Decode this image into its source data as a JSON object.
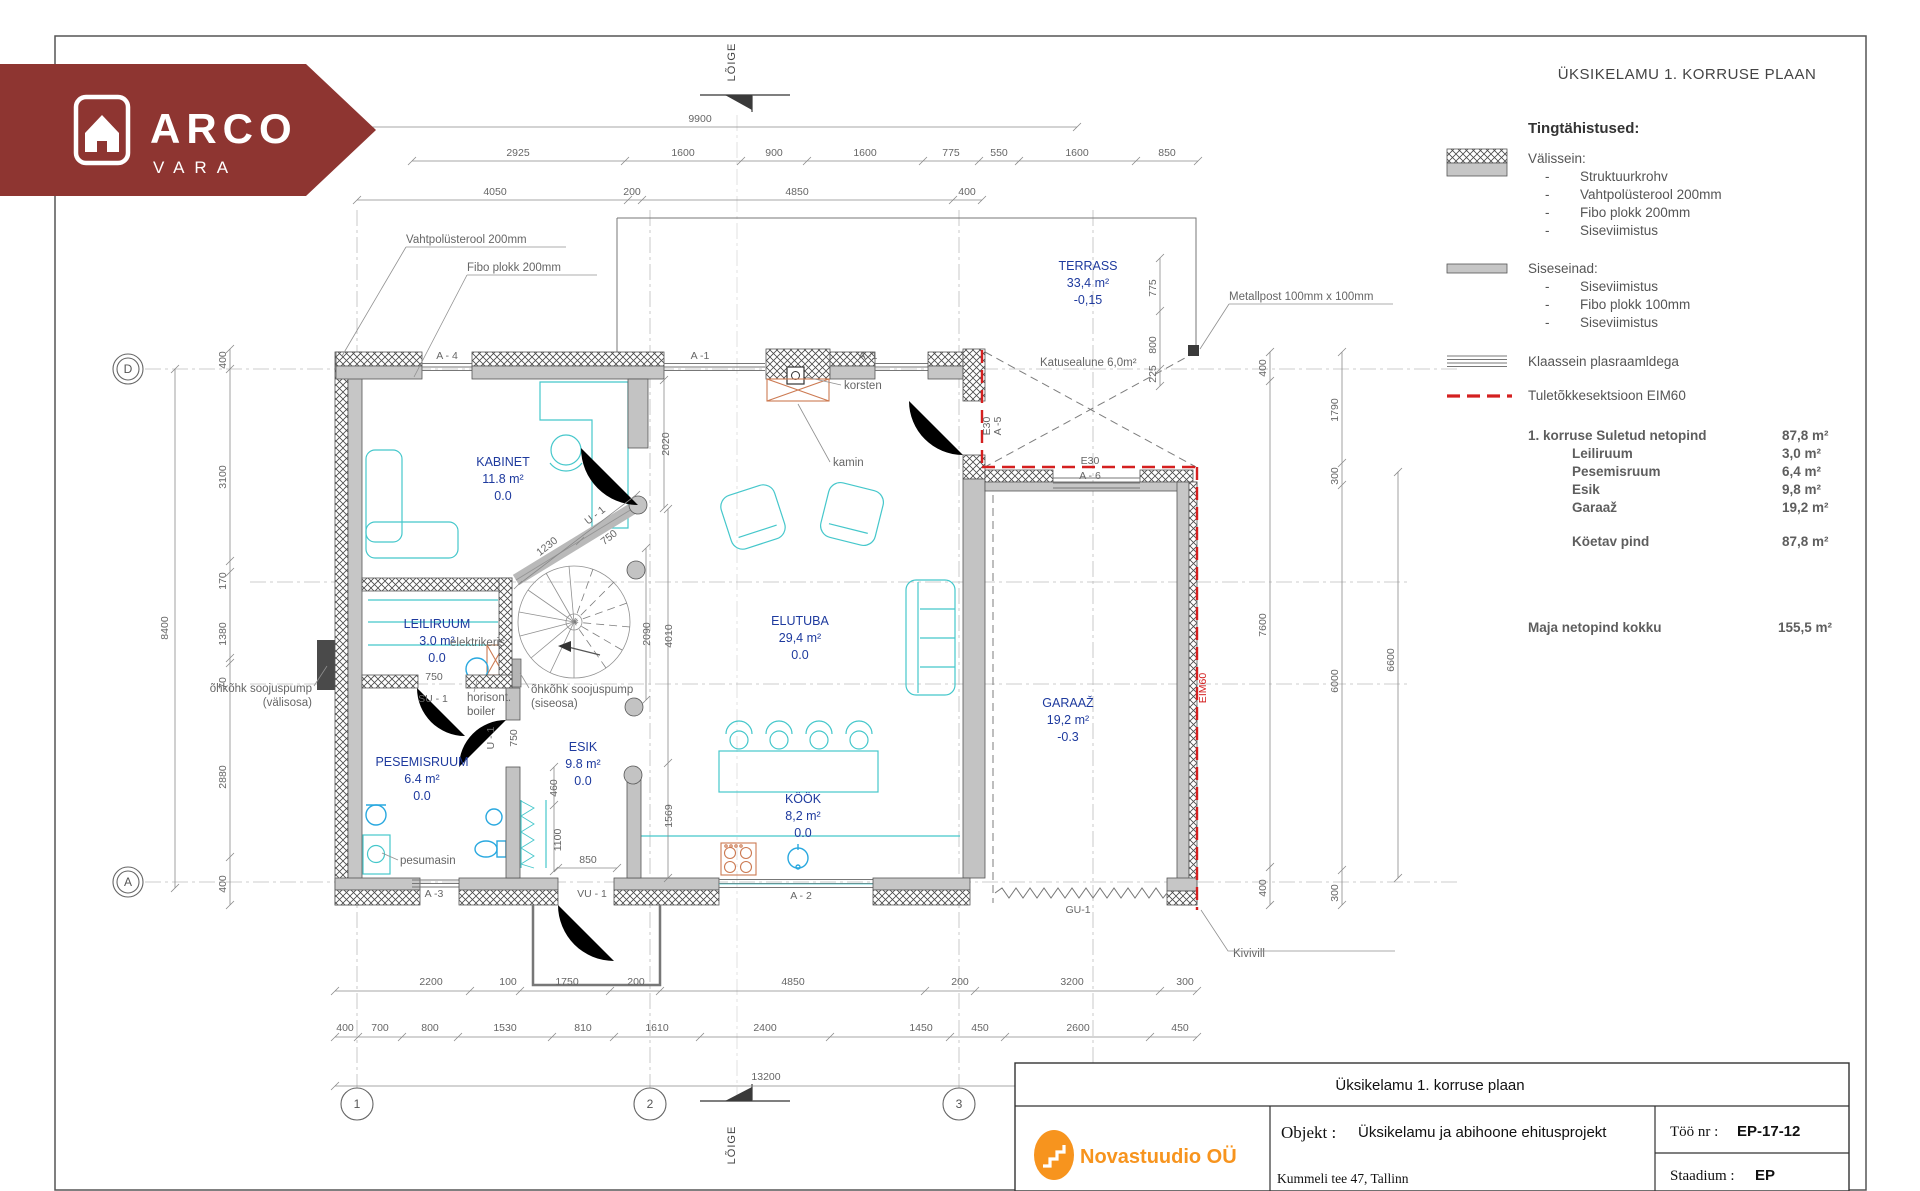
{
  "colors": {
    "banner": "#8e3531",
    "logo_orange": "#f7941e",
    "room_label": "#1e3a9e",
    "furniture_cyan": "#45c7cb",
    "fire_red": "#d42020"
  },
  "brand": {
    "line1": "ARCO",
    "line2": "VARA"
  },
  "drawing_header": {
    "title": "ÜKSIKELAMU 1. KORRUSE PLAAN"
  },
  "legend": {
    "heading": "Tingtähistused:",
    "bullet": "-",
    "exterior": {
      "label": "Välissein:",
      "items": [
        "Struktuurkrohv",
        "Vahtpolüsterool 200mm",
        "Fibo plokk 200mm",
        "Siseviimistus"
      ]
    },
    "interior": {
      "label": "Siseseinad:",
      "items": [
        "Siseviimistus",
        "Fibo plokk 100mm",
        "Siseviimistus"
      ]
    },
    "glass": "Klaassein plasraamldega",
    "fire": "Tuletõkkesektsioon EIM60"
  },
  "areas": {
    "header": {
      "label": "1. korruse Suletud netopind",
      "value": "87,8  m²"
    },
    "rows": [
      {
        "label": "Leiliruum",
        "value": "3,0 m²"
      },
      {
        "label": "Pesemisruum",
        "value": "6,4 m²"
      },
      {
        "label": "Esik",
        "value": "9,8 m²"
      },
      {
        "label": "Garaaž",
        "value": "19,2 m²"
      }
    ],
    "heated": {
      "label": "Köetav pind",
      "value": "87,8 m²"
    },
    "total": {
      "label": "Maja netopind kokku",
      "value": "155,5 m²"
    }
  },
  "title_block": {
    "drawing_name": "Üksikelamu 1. korruse plaan",
    "company": "Novastuudio OÜ",
    "object_label": "Objekt :",
    "object_value": "Üksikelamu ja abihoone ehitusprojekt",
    "address": "Kummeli tee 47, Tallinn",
    "work_no_label": "Töö nr :",
    "work_no_value": "EP-17-12",
    "stage_label": "Staadium :",
    "stage_value": "EP"
  },
  "plan": {
    "grid_cols": [
      "1",
      "2",
      "3"
    ],
    "grid_rows": [
      "D",
      "A"
    ],
    "section_label": "LÕIGE",
    "rooms": [
      {
        "name": "KABINET",
        "area": "11.8 m²",
        "level": "0.0",
        "x": 503,
        "y": 466
      },
      {
        "name": "LEILIRUUM",
        "area": "3.0 m²",
        "level": "0.0",
        "x": 437,
        "y": 628
      },
      {
        "name": "PESEMISRUUM",
        "area": "6.4 m²",
        "level": "0.0",
        "x": 422,
        "y": 766
      },
      {
        "name": "ESIK",
        "area": "9.8 m²",
        "level": "0.0",
        "x": 583,
        "y": 751
      },
      {
        "name": "ELUTUBA",
        "area": "29,4 m²",
        "level": "0.0",
        "x": 800,
        "y": 625
      },
      {
        "name": "KÖÖK",
        "area": "8,2 m²",
        "level": "0.0",
        "x": 803,
        "y": 803
      },
      {
        "name": "GARAAŽ",
        "area": "19,2 m²",
        "level": "-0.3",
        "x": 1068,
        "y": 707
      },
      {
        "name": "TERRASS",
        "area": "33,4 m²",
        "level": "-0,15",
        "x": 1088,
        "y": 270
      }
    ],
    "callouts": [
      {
        "t": "Vahtpolüsterool 200mm",
        "x": 406,
        "y": 243,
        "ul": 566,
        "lead": "406,247 342,356"
      },
      {
        "t": "Fibo plokk 200mm",
        "x": 467,
        "y": 271,
        "ul": 597,
        "lead": "467,275 414,377"
      },
      {
        "t": "Metallpost 100mm x 100mm",
        "x": 1229,
        "y": 300,
        "ul": 1393,
        "lead": "1229,304 1200,349"
      },
      {
        "t": "korsten",
        "x": 844,
        "y": 389,
        "lead": "841,385 806,377"
      },
      {
        "t": "kamin",
        "x": 833,
        "y": 466,
        "lead": "830,462 798,404"
      },
      {
        "t": "õhkõhk soojuspump",
        "t2": "(välisosa)",
        "x": 312,
        "y": 692,
        "end": true,
        "lead": "314,686 327,666"
      },
      {
        "t": "õhkõhk soojuspump",
        "t2": "(siseosa)",
        "x": 531,
        "y": 693,
        "lead": "529,688 520,673"
      },
      {
        "t": "horisont.",
        "t2": "boiler",
        "x": 467,
        "y": 701,
        "lead": "474,692 477,681"
      },
      {
        "t": "elektrikeris",
        "x": 450,
        "y": 646
      },
      {
        "t": "pesumasin",
        "x": 400,
        "y": 864,
        "lead": "398,860 382,853"
      },
      {
        "t": "Kivivill",
        "x": 1233,
        "y": 957,
        "lead": "1201,910 1228,951 1395,951"
      },
      {
        "t": "Katusealune 6,0m²",
        "x": 1040,
        "y": 366
      }
    ],
    "wall_tags": [
      {
        "t": "A - 4",
        "x": 447,
        "y": 359
      },
      {
        "t": "A -1",
        "x": 700,
        "y": 359
      },
      {
        "t": "A -1",
        "x": 868,
        "y": 359
      },
      {
        "t": "A -3",
        "x": 434,
        "y": 897
      },
      {
        "t": "A - 2",
        "x": 801,
        "y": 899
      },
      {
        "t": "SU - 1",
        "x": 433,
        "y": 702
      },
      {
        "t": "VU - 1",
        "x": 592,
        "y": 897
      },
      {
        "t": "GU-1",
        "x": 1078,
        "y": 913
      },
      {
        "t": "U - 1",
        "x": 597,
        "y": 518,
        "r": -38
      },
      {
        "t": "U - 1",
        "x": 494,
        "y": 738,
        "r": -90
      },
      {
        "t": "E30",
        "x": 1090,
        "y": 464
      },
      {
        "t": "A - 6",
        "x": 1090,
        "y": 479
      },
      {
        "t": "E30",
        "x": 990,
        "y": 426,
        "r": -90
      },
      {
        "t": "A -5",
        "x": 1001,
        "y": 426,
        "r": -90
      },
      {
        "t": "EIM60",
        "x": 1206,
        "y": 688,
        "r": -90,
        "red": true
      }
    ],
    "dims": [
      {
        "v": "9900",
        "x": 700,
        "y": 122
      },
      {
        "v": "2925",
        "x": 518,
        "y": 156
      },
      {
        "v": "1600",
        "x": 683,
        "y": 156
      },
      {
        "v": "900",
        "x": 774,
        "y": 156
      },
      {
        "v": "1600",
        "x": 865,
        "y": 156
      },
      {
        "v": "775",
        "x": 951,
        "y": 156
      },
      {
        "v": "550",
        "x": 999,
        "y": 156
      },
      {
        "v": "1600",
        "x": 1077,
        "y": 156
      },
      {
        "v": "850",
        "x": 1167,
        "y": 156
      },
      {
        "v": "4050",
        "x": 495,
        "y": 195
      },
      {
        "v": "200",
        "x": 632,
        "y": 195
      },
      {
        "v": "4850",
        "x": 797,
        "y": 195
      },
      {
        "v": "400",
        "x": 967,
        "y": 195
      },
      {
        "v": "8400",
        "x": 168,
        "y": 628,
        "r": -90
      },
      {
        "v": "400",
        "x": 226,
        "y": 360,
        "r": -90
      },
      {
        "v": "3100",
        "x": 226,
        "y": 477,
        "r": -90
      },
      {
        "v": "170",
        "x": 226,
        "y": 581,
        "r": -90
      },
      {
        "v": "1380",
        "x": 226,
        "y": 634,
        "r": -90
      },
      {
        "v": "70",
        "x": 226,
        "y": 683,
        "r": -90
      },
      {
        "v": "2880",
        "x": 226,
        "y": 777,
        "r": -90
      },
      {
        "v": "400",
        "x": 226,
        "y": 884,
        "r": -90
      },
      {
        "v": "775",
        "x": 1156,
        "y": 288,
        "r": -90
      },
      {
        "v": "800",
        "x": 1156,
        "y": 345,
        "r": -90
      },
      {
        "v": "225",
        "x": 1156,
        "y": 374,
        "r": -90
      },
      {
        "v": "400",
        "x": 1266,
        "y": 368,
        "r": -90
      },
      {
        "v": "7600",
        "x": 1266,
        "y": 625,
        "r": -90
      },
      {
        "v": "400",
        "x": 1266,
        "y": 888,
        "r": -90
      },
      {
        "v": "1790",
        "x": 1338,
        "y": 410,
        "r": -90
      },
      {
        "v": "300",
        "x": 1338,
        "y": 476,
        "r": -90
      },
      {
        "v": "6000",
        "x": 1338,
        "y": 681,
        "r": -90
      },
      {
        "v": "300",
        "x": 1338,
        "y": 893,
        "r": -90
      },
      {
        "v": "6600",
        "x": 1394,
        "y": 660,
        "r": -90
      },
      {
        "v": "2200",
        "x": 431,
        "y": 985
      },
      {
        "v": "100",
        "x": 508,
        "y": 985
      },
      {
        "v": "1750",
        "x": 567,
        "y": 985
      },
      {
        "v": "200",
        "x": 636,
        "y": 985
      },
      {
        "v": "4850",
        "x": 793,
        "y": 985
      },
      {
        "v": "200",
        "x": 960,
        "y": 985
      },
      {
        "v": "3200",
        "x": 1072,
        "y": 985
      },
      {
        "v": "300",
        "x": 1185,
        "y": 985
      },
      {
        "v": "400",
        "x": 345,
        "y": 1031
      },
      {
        "v": "700",
        "x": 380,
        "y": 1031
      },
      {
        "v": "800",
        "x": 430,
        "y": 1031
      },
      {
        "v": "1530",
        "x": 505,
        "y": 1031
      },
      {
        "v": "810",
        "x": 583,
        "y": 1031
      },
      {
        "v": "1610",
        "x": 657,
        "y": 1031
      },
      {
        "v": "2400",
        "x": 765,
        "y": 1031
      },
      {
        "v": "1450",
        "x": 921,
        "y": 1031
      },
      {
        "v": "450",
        "x": 980,
        "y": 1031
      },
      {
        "v": "2600",
        "x": 1078,
        "y": 1031
      },
      {
        "v": "450",
        "x": 1180,
        "y": 1031
      },
      {
        "v": "13200",
        "x": 766,
        "y": 1080
      },
      {
        "v": "2020",
        "x": 669,
        "y": 444,
        "r": -90
      },
      {
        "v": "2090",
        "x": 650,
        "y": 634,
        "r": -90
      },
      {
        "v": "4010",
        "x": 672,
        "y": 636,
        "r": -90
      },
      {
        "v": "1569",
        "x": 672,
        "y": 816,
        "r": -90
      },
      {
        "v": "1230",
        "x": 549,
        "y": 549,
        "r": -38
      },
      {
        "v": "750",
        "x": 611,
        "y": 540,
        "r": -38
      },
      {
        "v": "750",
        "x": 434,
        "y": 680
      },
      {
        "v": "750",
        "x": 517,
        "y": 738,
        "r": -90
      },
      {
        "v": "460",
        "x": 557,
        "y": 788,
        "r": -90
      },
      {
        "v": "1100",
        "x": 561,
        "y": 840,
        "r": -90
      },
      {
        "v": "850",
        "x": 588,
        "y": 863
      }
    ]
  }
}
